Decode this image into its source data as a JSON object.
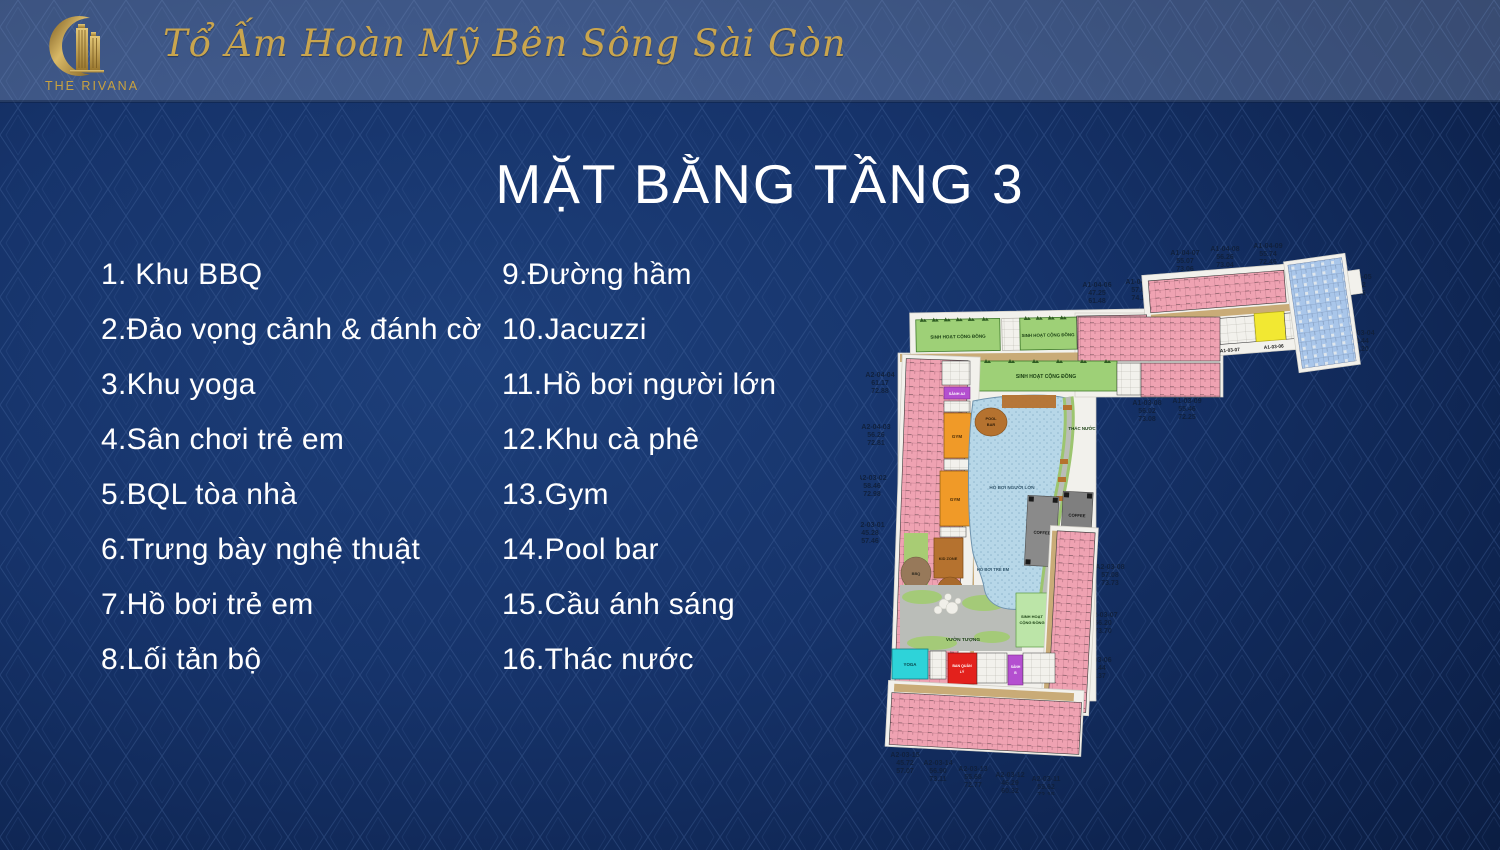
{
  "header": {
    "brand": "THE RIVANA",
    "tagline": "Tổ Ấm Hoàn Mỹ Bên Sông Sài Gòn"
  },
  "title": "MẶT BẰNG TẦNG 3",
  "legend": {
    "left": [
      "1. Khu BBQ",
      "2.Đảo vọng cảnh & đánh cờ",
      "3.Khu yoga",
      "4.Sân chơi trẻ em",
      "5.BQL tòa nhà",
      "6.Trưng bày nghệ thuật",
      "7.Hồ bơi trẻ em",
      "8.Lối tản bộ"
    ],
    "right": [
      "9.Đường hầm",
      "10.Jacuzzi",
      "11.Hồ bơi người lớn",
      "12.Khu cà phê",
      "13.Gym",
      "14.Pool bar",
      "15.Cầu ánh sáng",
      "16.Thác nước"
    ]
  },
  "floor_plan": {
    "labels": {
      "community_1": "SINH HOẠT CỘNG ĐỒNG",
      "community_2": "SINH HOẠT CỘNG ĐỒNG",
      "community_3": "SINH HOẠT CỘNG ĐỒNG",
      "community_4_line1": "SINH HOẠT",
      "community_4_line2": "CỘNG ĐỒNG",
      "adult_pool": "HỒ BƠI NGƯỜI LỚN",
      "kids_pool": "HỒ BƠI TRẺ EM",
      "waterfall": "THÁC NƯỚC",
      "pool_bar_line1": "POOL",
      "pool_bar_line2": "BAR",
      "gym_1": "GYM",
      "gym_2": "GYM",
      "kid_zone": "KID ZONE",
      "bbq": "BBQ",
      "coffee_1": "COFFEE",
      "coffee_2": "COFFEE",
      "statue_garden": "VƯỜN TƯỢNG",
      "yoga": "YOGA",
      "management_line1": "BAN QUẢN",
      "management_line2": "LÝ",
      "lobby_a2": "SẢNH A2",
      "lobby_b_line1": "SẢNH",
      "lobby_b_line2": "B",
      "unit_code_1": "A1-03-07",
      "unit_code_2": "A1-03-06"
    },
    "colors": {
      "pink": "#efa2b2",
      "green": "#9ed077",
      "light_green": "#bce5a8",
      "pool_blue": "#b7d7e8",
      "orange": "#f09a28",
      "brown": "#b5722f",
      "bbq_brown": "#97795a",
      "gray": "#7f7f7f",
      "cyan": "#2ed3d9",
      "red": "#e3211c",
      "magenta": "#c94fd4",
      "purple": "#b44fd0",
      "yellow": "#f2e832",
      "blue_units": "#a9c6ea",
      "tan": "#c9ab77",
      "lawn": "#a8cc74",
      "paving": "#babdb8",
      "base_white": "#f2f1ec"
    },
    "outside_labels": [
      {
        "code": "A1-04-07",
        "a": "55.07",
        "b": "73.06"
      },
      {
        "code": "A1-04-08",
        "a": "56.26",
        "b": "73.04"
      },
      {
        "code": "A1-04-09",
        "a": "55.74",
        "b": "72.46"
      },
      {
        "code": "A1-04-06",
        "a": "47.25",
        "b": "61.48"
      },
      {
        "code": "A1-04-10",
        "a": "57.01",
        "b": "74.11"
      },
      {
        "code": "A1-03-05",
        "a": "90.12",
        "b": "99.45"
      },
      {
        "code": "A1-03-04",
        "a": "92.44",
        "b": "99.20"
      },
      {
        "code": "A1-03-08",
        "a": "56.02",
        "b": "73.08"
      },
      {
        "code": "A1-03-09",
        "a": "55.46",
        "b": "72.25"
      },
      {
        "code": "A2-04-04",
        "a": "61.17",
        "b": "72.88"
      },
      {
        "code": "A2-04-03",
        "a": "56.26",
        "b": "72.81"
      },
      {
        "code": "A2-03-02",
        "a": "58.46",
        "b": "72.98"
      },
      {
        "code": "A2-03-01",
        "a": "45.28",
        "b": "57.46"
      },
      {
        "code": "A2-03-08",
        "a": "57.08",
        "b": "73.73"
      },
      {
        "code": "A2-03-07",
        "a": "56.20",
        "b": "73.70"
      },
      {
        "code": "A2-03-06",
        "a": "55.44",
        "b": "72.37"
      },
      {
        "code": "A2-03-15",
        "a": "45.72",
        "b": "57.07"
      },
      {
        "code": "A2-03-14",
        "a": "56.90",
        "b": "73.11"
      },
      {
        "code": "A2-03-13",
        "a": "55.68",
        "b": "72.77"
      },
      {
        "code": "A2-03-12",
        "a": "46.29",
        "b": "60.32"
      },
      {
        "code": "A2-03-11",
        "a": "55.62",
        "b": "72.15"
      }
    ]
  }
}
